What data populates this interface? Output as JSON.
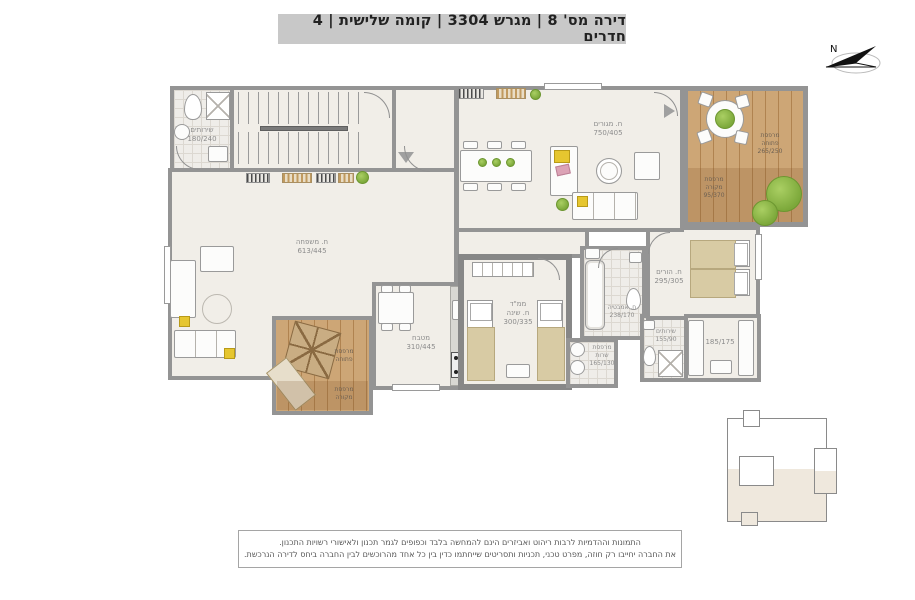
{
  "title": "דירה מס' 8 | מגרש 3304 | קומה שלישית | 4 חדרים",
  "compass": {
    "north_label": "N"
  },
  "rooms": {
    "wc_top": {
      "name": "שירותים",
      "dims": "180/240"
    },
    "family": {
      "name": "ח. משפחה",
      "dims": "613/445"
    },
    "living": {
      "name": "ח. מגורים",
      "dims": "750/405"
    },
    "balcony_tr_open": {
      "name": "מרפסת",
      "name2": "פתוחה",
      "dims": "265/250"
    },
    "balcony_tr_cov": {
      "name": "מרפסת",
      "name2": "מקורה",
      "dims": "95/370"
    },
    "parents": {
      "name": "ח. הורים",
      "dims": "295/305"
    },
    "closet": {
      "dims": "185/175"
    },
    "mamad": {
      "name": "ממ\"ד",
      "name2": "ח. שינה",
      "dims": "300/335"
    },
    "kitchen": {
      "name": "מטבח",
      "dims": "310/445"
    },
    "bath": {
      "name": "ח. אמבטיה",
      "dims": "238/170"
    },
    "service": {
      "name": "מרפסת",
      "name2": "שרות",
      "dims": "165/130"
    },
    "wc_small": {
      "name": "שירותים",
      "dims": "155/90"
    },
    "balcony_bl_open": {
      "name": "מרפסת",
      "name2": "פתוחה"
    },
    "balcony_bl_cov": {
      "name": "מרפסת",
      "name2": "מקורה"
    }
  },
  "legend_disclaimer": {
    "line1": "התמונות וההדמיות לרבות ריהוט ואביזרים הינם להמחשה בלבד וכפופים לגמר תכנון ולאישורי רשויות התכנון.",
    "line2": "את החברה יחייבו רק חוזה, מפרט טכני, תכניות ותסריטים שייחתמו כדין בין כל אחד מהרוכשים לבין החברה ביחס לדירה הנרכשת."
  },
  "colors": {
    "title_bg": "#c8c8c8",
    "wall": "#949494",
    "floor": "#f1eee8",
    "wood_deck": "#cda676",
    "accent_green": "#8cb844",
    "accent_yellow": "#e6c62f",
    "label_gray": "#8c8c8c"
  }
}
